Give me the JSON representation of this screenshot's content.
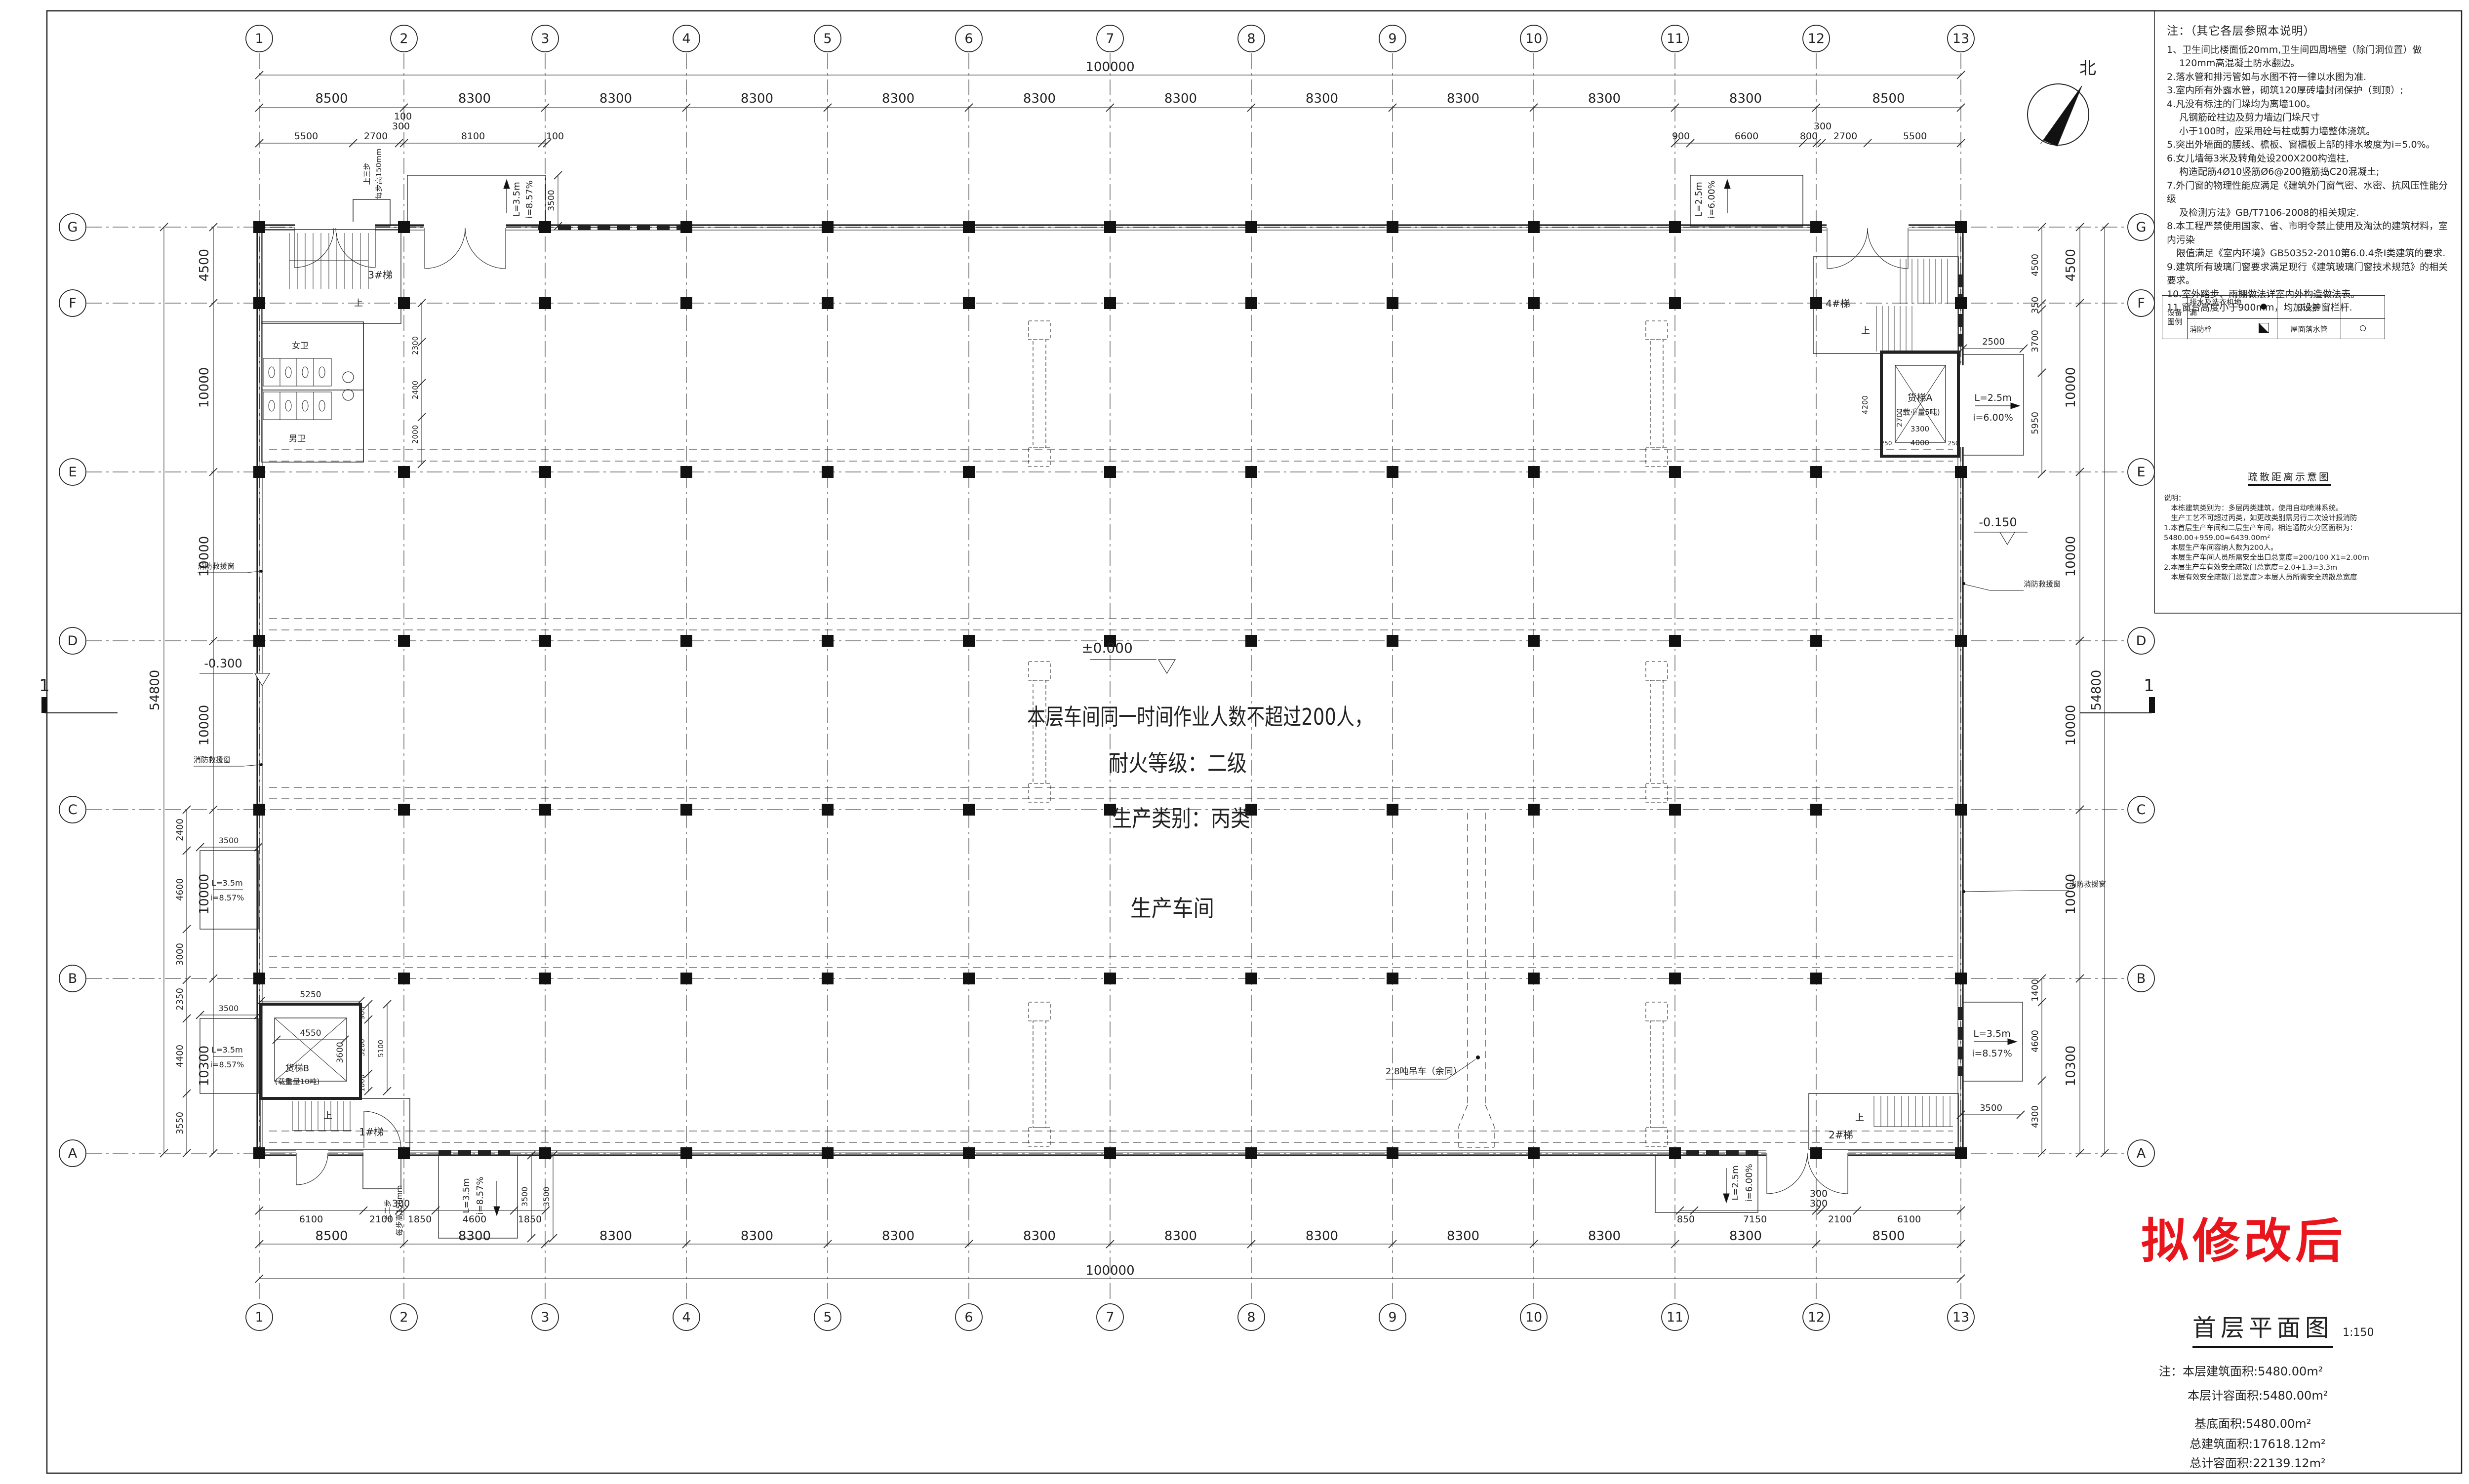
{
  "sheet": {
    "bg": "#ffffff",
    "line_color": "#222222",
    "stamp_red": "#e8151c"
  },
  "compass": {
    "label": "北"
  },
  "grid": {
    "col_labels": [
      "1",
      "2",
      "3",
      "4",
      "5",
      "6",
      "7",
      "8",
      "9",
      "10",
      "11",
      "12",
      "13"
    ],
    "row_labels": [
      "G",
      "F",
      "E",
      "D",
      "C",
      "B",
      "A"
    ],
    "bay_dims": [
      "8500",
      "8300",
      "8300",
      "8300",
      "8300",
      "8300",
      "8300",
      "8300",
      "8300",
      "8300",
      "8300",
      "8500"
    ],
    "row_dims": [
      "4500",
      "10000",
      "10000",
      "10000",
      "10000",
      "10300"
    ],
    "total_width": "100000",
    "total_height": "54800"
  },
  "sub_dims": {
    "top_left": [
      "5500",
      "2700",
      "300",
      "8100",
      "100"
    ],
    "top_left_extra": "100",
    "top_right": [
      "900",
      "6600",
      "800",
      "300",
      "2700",
      "5500"
    ],
    "bottom_left": [
      "6100",
      "2100",
      "300",
      "1850",
      "4600",
      "1850"
    ],
    "bottom_right": [
      "850",
      "7150",
      "300",
      "2100",
      "6100"
    ],
    "bottom_right_extra": "300",
    "left_side": [
      "2400",
      "4600",
      "3000",
      "2350",
      "4400",
      "3550"
    ],
    "right_top": [
      "4500",
      "350",
      "3700",
      "5950"
    ],
    "right_bottom": [
      "1400",
      "4600",
      "4300"
    ]
  },
  "center_text": {
    "line1": "本层车间同一时间作业人数不超过200人，",
    "line2": "耐火等级：二级",
    "line3": "生产类别：丙类",
    "line4": "生产车间"
  },
  "levels": {
    "zero": "±0.000",
    "neg300": "-0.300",
    "neg150": "-0.150"
  },
  "rooms": {
    "stair1": "1#梯",
    "stair2": "2#梯",
    "stair3": "3#梯",
    "stair4": "4#梯",
    "up": "上",
    "female_wc": "女卫",
    "male_wc": "男卫",
    "lift_a": "货梯A",
    "lift_a_cap": "(载重量5吨)",
    "lift_b": "货梯B",
    "lift_b_cap": "(载重量10吨)"
  },
  "annotations": {
    "rescue_window": "消防救援窗",
    "crane": "2.8吨吊车（余同）",
    "steps3": "上三步",
    "steps2": "上二步",
    "step_h": "每步高150mm",
    "canopy_l35": "L=3.5m",
    "canopy_i857": "i=8.57%",
    "canopy_l25": "L=2.5m",
    "canopy_i600": "i=6.00%",
    "c3500": "3500",
    "c2500": "2500",
    "section": "1",
    "wc_dims": [
      "2300",
      "2400",
      "2000"
    ],
    "lift_b_dims": {
      "w": "4550",
      "h": "3600",
      "r1": "900",
      "r2": "3200",
      "r3": "1000",
      "r4": "5100",
      "top": "5250"
    },
    "lift_a_dims": {
      "w": "3300",
      "w2": "4000",
      "h": "2700",
      "h2": "4200",
      "s1": "250",
      "s2": "250"
    }
  },
  "notes": {
    "title": "注：（其它各层参照本说明）",
    "items": [
      "1、卫生间比楼面低20mm,卫生间四周墙壁（除门洞位置）做",
      "　 120mm高混凝土防水翻边。",
      "2.落水管和排污管如与水图不符一律以水图为准.",
      "3.室内所有外露水管，砌筑120厚砖墙封闭保护（到顶）;",
      "4.凡没有标注的门垛均为离墙100。",
      "　 凡钢筋砼柱边及剪力墙边门垛尺寸",
      "　 小于100时，应采用砼与柱或剪力墙整体浇筑。",
      "5.突出外墙面的腰线、檐板、窗楣板上部的排水坡度为i=5.0%。",
      "6.女儿墙每3米及转角处设200X200构造柱,",
      "　 构造配筋4Ø10竖筋Ø6@200箍筋捣C20混凝土;",
      "7.外门窗的物理性能应满足《建筑外门窗气密、水密、抗风压性能分级",
      "　 及检测方法》GB/T7106-2008的相关规定.",
      "8.本工程严禁使用国家、省、市明令禁止使用及淘汰的建筑材料，室内污染",
      "　限值满足《室内环境》GB50352-2010第6.0.4条I类建筑的要求.",
      "9.建筑所有玻璃门窗要求满足现行《建筑玻璃门窗技术规范》的相关要求。",
      "10.室外踏步、雨棚做法详室内外构造做法表。",
      "11.窗台高度小于900mm，均加设护窗栏杆."
    ]
  },
  "legend": {
    "header_line1": "设备",
    "header_line2": "图例",
    "row1": [
      "排水及洗衣机地漏",
      "灭火器"
    ],
    "row2": [
      "消防栓",
      "屋面落水管"
    ],
    "symbols": {
      "drain": "filled-circle",
      "hydrant": "half-filled-square",
      "downpipe": "open-circle"
    }
  },
  "evac": {
    "title": "疏散距离示意图",
    "lines": [
      "说明：",
      "　本栋建筑类别为：多层丙类建筑，使用自动喷淋系统。",
      "　生产工艺不可超过丙类，如更改类别需另行二次设计报消防",
      "1.本首层生产车间和二层生产车间，相连通防火分区面积为：5480.00+959.00=6439.00m²",
      "　本层生产车间容纳人数为200人。",
      "　本层生产车间人员所需安全出口总宽度=200/100 X1=2.00m",
      "2.本层生产车有效安全疏散门总宽度=2.0+1.3=3.3m",
      "　本层有效安全疏散门总宽度＞本层人员所需安全疏散总宽度"
    ]
  },
  "titleblock": {
    "stamp": "拟修改后",
    "title": "首层平面图",
    "scale": "1:150",
    "areas": [
      "注：本层建筑面积:5480.00m²",
      "本层计容面积:5480.00m²",
      "基底面积:5480.00m²",
      "总建筑面积:17618.12m²",
      "总计容面积:22139.12m²"
    ]
  }
}
